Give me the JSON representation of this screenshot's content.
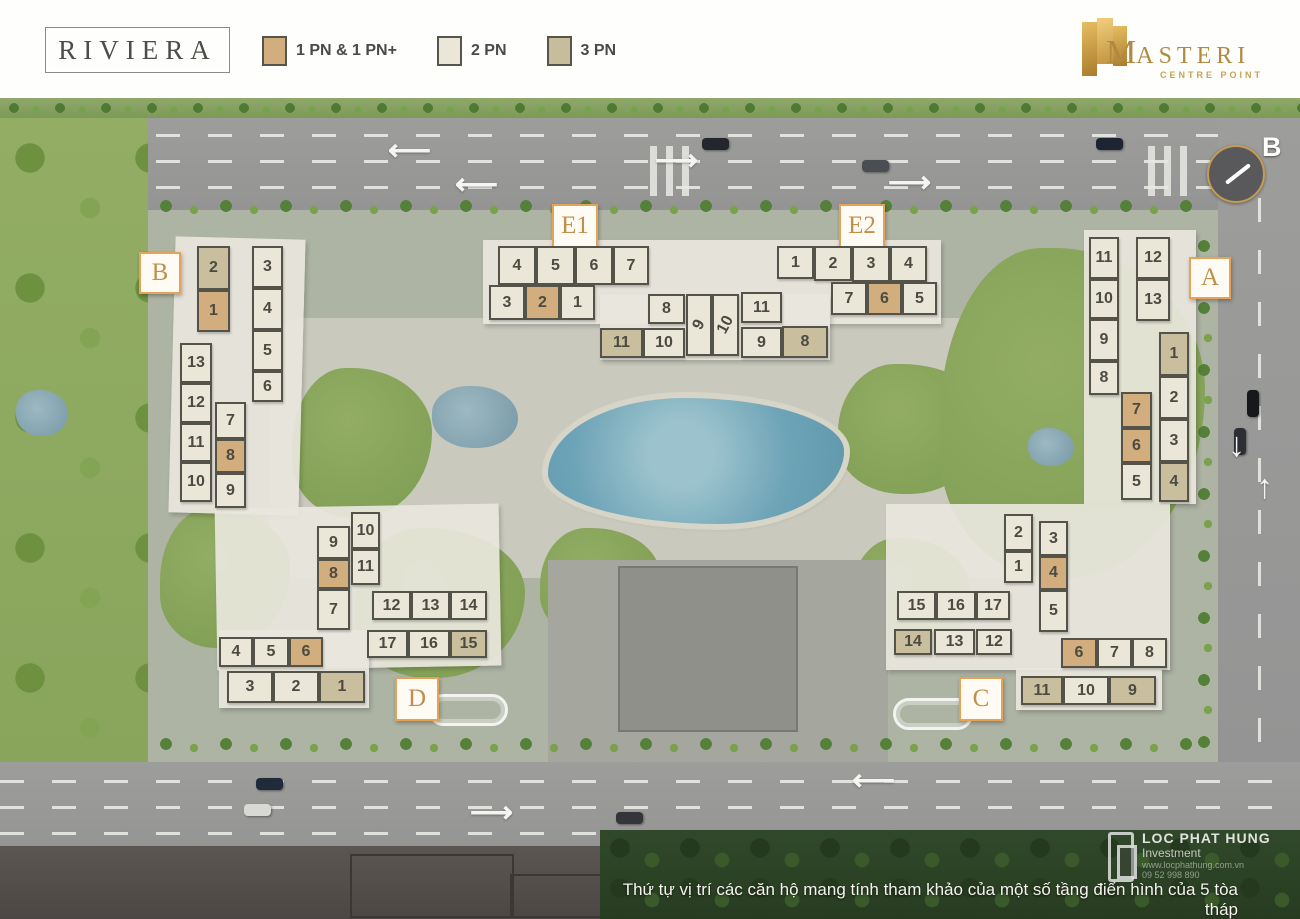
{
  "header": {
    "title": "RIVIERA",
    "legend": [
      {
        "label": "1 PN & 1 PN+",
        "type": "1pn",
        "color": "#d2ad7d"
      },
      {
        "label": "2 PN",
        "type": "2pn",
        "color": "#eae6d8"
      },
      {
        "label": "3 PN",
        "type": "3pn",
        "color": "#c9bf9e"
      }
    ],
    "brand": {
      "name_initial": "M",
      "name_rest": "ASTERI",
      "subtitle": "CENTRE POINT"
    }
  },
  "compass": {
    "label": "B"
  },
  "icons": {
    "arrow_left": "⟵",
    "arrow_right": "⟶",
    "arrow_up": "↑",
    "arrow_down": "↓"
  },
  "colors": {
    "unit_1pn": "#d2ad7d",
    "unit_2pn": "#eae6d8",
    "unit_3pn": "#c9bf9e",
    "accent_orange": "#e6a257",
    "brand_gold": "#b18a41",
    "pool_blue": "#6ea4b7"
  },
  "footer": {
    "note": "Thứ tự vị trí các căn hộ mang tính tham khảo của một số tầng điển hình của 5 tòa tháp"
  },
  "watermark": {
    "line1": "LOC PHAT HUNG",
    "line2": "Investment",
    "line3": "www.locphathung.com.vn",
    "line4": "09 52 998 890"
  },
  "buildings": [
    {
      "id": "B",
      "label": "B",
      "cells": [
        {
          "n": "2",
          "t": "3pn"
        },
        {
          "n": "1",
          "t": "1pn"
        },
        {
          "n": "3",
          "t": "2pn"
        },
        {
          "n": "4",
          "t": "2pn"
        },
        {
          "n": "5",
          "t": "2pn"
        },
        {
          "n": "6",
          "t": "2pn"
        },
        {
          "n": "13",
          "t": "2pn"
        },
        {
          "n": "12",
          "t": "2pn"
        },
        {
          "n": "11",
          "t": "2pn"
        },
        {
          "n": "10",
          "t": "2pn"
        },
        {
          "n": "7",
          "t": "2pn"
        },
        {
          "n": "8",
          "t": "1pn"
        },
        {
          "n": "9",
          "t": "2pn"
        }
      ]
    },
    {
      "id": "E1",
      "label": "E1",
      "cells": [
        {
          "n": "4",
          "t": "2pn"
        },
        {
          "n": "5",
          "t": "2pn"
        },
        {
          "n": "6",
          "t": "2pn"
        },
        {
          "n": "7",
          "t": "2pn"
        },
        {
          "n": "3",
          "t": "2pn"
        },
        {
          "n": "2",
          "t": "1pn"
        },
        {
          "n": "1",
          "t": "2pn"
        },
        {
          "n": "8",
          "t": "2pn"
        },
        {
          "n": "9",
          "t": "2pn"
        },
        {
          "n": "11",
          "t": "3pn"
        },
        {
          "n": "10",
          "t": "2pn"
        }
      ]
    },
    {
      "id": "E2",
      "label": "E2",
      "cells": [
        {
          "n": "1",
          "t": "2pn"
        },
        {
          "n": "2",
          "t": "2pn"
        },
        {
          "n": "3",
          "t": "2pn"
        },
        {
          "n": "4",
          "t": "2pn"
        },
        {
          "n": "7",
          "t": "2pn"
        },
        {
          "n": "6",
          "t": "1pn"
        },
        {
          "n": "5",
          "t": "2pn"
        },
        {
          "n": "10",
          "t": "2pn"
        },
        {
          "n": "11",
          "t": "2pn"
        },
        {
          "n": "9",
          "t": "2pn"
        },
        {
          "n": "8",
          "t": "3pn"
        }
      ]
    },
    {
      "id": "A",
      "label": "A",
      "cells": [
        {
          "n": "11",
          "t": "2pn"
        },
        {
          "n": "10",
          "t": "2pn"
        },
        {
          "n": "9",
          "t": "2pn"
        },
        {
          "n": "8",
          "t": "2pn"
        },
        {
          "n": "12",
          "t": "2pn"
        },
        {
          "n": "13",
          "t": "2pn"
        },
        {
          "n": "1",
          "t": "3pn"
        },
        {
          "n": "2",
          "t": "2pn"
        },
        {
          "n": "3",
          "t": "2pn"
        },
        {
          "n": "4",
          "t": "3pn"
        },
        {
          "n": "7",
          "t": "1pn"
        },
        {
          "n": "6",
          "t": "1pn"
        },
        {
          "n": "5",
          "t": "2pn"
        }
      ]
    },
    {
      "id": "D",
      "label": "D",
      "cells": [
        {
          "n": "9",
          "t": "2pn"
        },
        {
          "n": "8",
          "t": "1pn"
        },
        {
          "n": "7",
          "t": "2pn"
        },
        {
          "n": "10",
          "t": "2pn"
        },
        {
          "n": "11",
          "t": "2pn"
        },
        {
          "n": "12",
          "t": "2pn"
        },
        {
          "n": "13",
          "t": "2pn"
        },
        {
          "n": "14",
          "t": "2pn"
        },
        {
          "n": "17",
          "t": "2pn"
        },
        {
          "n": "16",
          "t": "2pn"
        },
        {
          "n": "15",
          "t": "3pn"
        },
        {
          "n": "4",
          "t": "2pn"
        },
        {
          "n": "5",
          "t": "2pn"
        },
        {
          "n": "6",
          "t": "1pn"
        },
        {
          "n": "3",
          "t": "2pn"
        },
        {
          "n": "2",
          "t": "2pn"
        },
        {
          "n": "1",
          "t": "3pn"
        }
      ]
    },
    {
      "id": "C",
      "label": "C",
      "cells": [
        {
          "n": "2",
          "t": "2pn"
        },
        {
          "n": "1",
          "t": "2pn"
        },
        {
          "n": "3",
          "t": "2pn"
        },
        {
          "n": "4",
          "t": "1pn"
        },
        {
          "n": "5",
          "t": "2pn"
        },
        {
          "n": "15",
          "t": "2pn"
        },
        {
          "n": "16",
          "t": "2pn"
        },
        {
          "n": "17",
          "t": "2pn"
        },
        {
          "n": "14",
          "t": "3pn"
        },
        {
          "n": "13",
          "t": "2pn"
        },
        {
          "n": "12",
          "t": "2pn"
        },
        {
          "n": "6",
          "t": "1pn"
        },
        {
          "n": "7",
          "t": "2pn"
        },
        {
          "n": "8",
          "t": "2pn"
        },
        {
          "n": "11",
          "t": "3pn"
        },
        {
          "n": "10",
          "t": "2pn"
        },
        {
          "n": "9",
          "t": "3pn"
        }
      ]
    }
  ]
}
